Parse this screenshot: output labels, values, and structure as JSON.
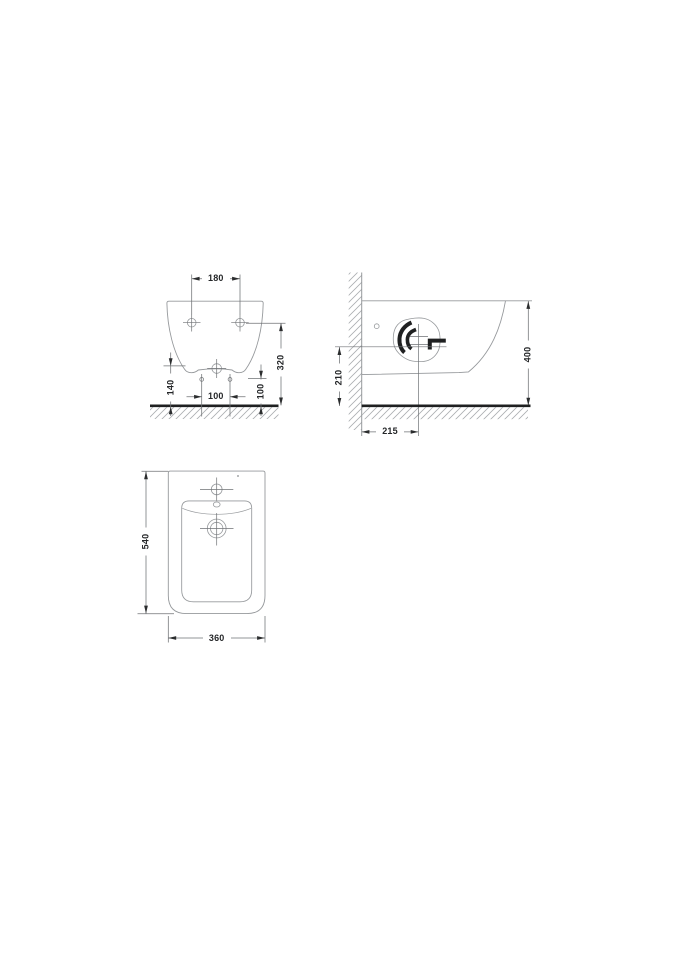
{
  "drawing": {
    "kind": "technical-drawing",
    "background": "#ffffff",
    "palette": {
      "outline": "#96999c",
      "dimension_line": "#6f7275",
      "arrow_and_text": "#2b2d2e",
      "section_floor": "#1f2021",
      "hatch": "#abaeb1"
    },
    "views": {
      "front": {
        "dims": {
          "hole_spacing": "180",
          "height": "320",
          "outlet_height": "140",
          "lower_hole_spacing": "100",
          "lower_hole_height": "100"
        }
      },
      "side": {
        "dims": {
          "height": "400",
          "outlet_height": "210",
          "outlet_from_wall": "215"
        }
      },
      "plan": {
        "dims": {
          "depth": "540",
          "width": "360"
        }
      }
    }
  }
}
